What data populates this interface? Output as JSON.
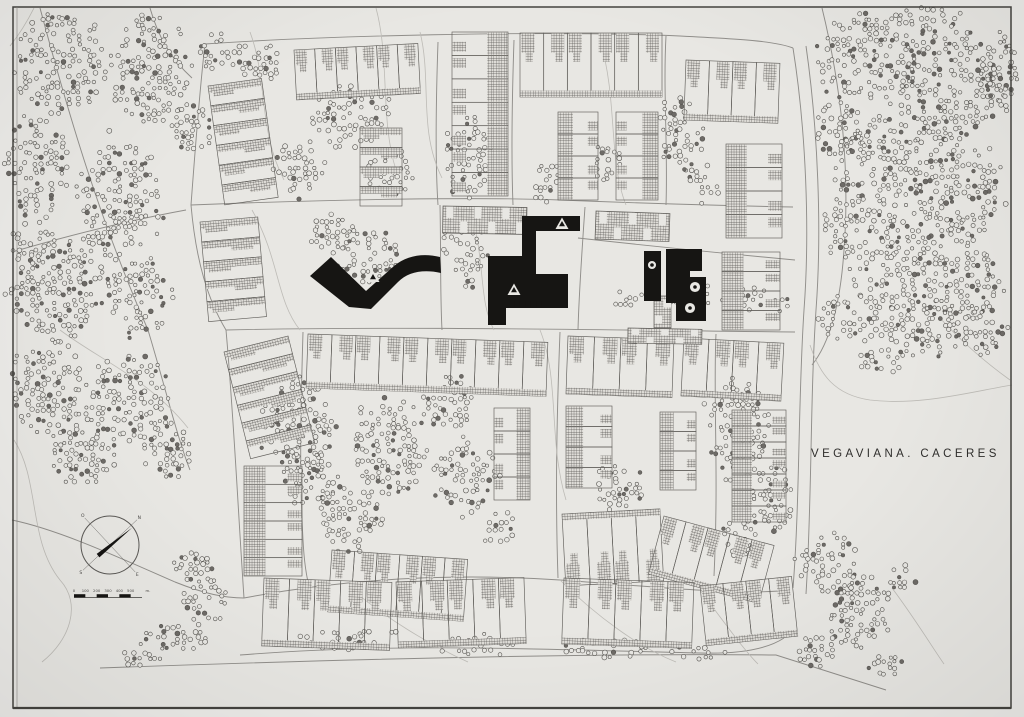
{
  "title": {
    "text": "VEGAVIANA. CACERES"
  },
  "palette": {
    "paper": "#e8e7e3",
    "margin": "#edece9",
    "frame": "#44433f",
    "road": "#908e8a",
    "faint": "#bdbbb6",
    "outline": "#605e5a",
    "tree_stroke": "#55534f",
    "tree_fill": "#6e6b67",
    "ink": "#161513",
    "hatch_bg": "#dedcd7",
    "hatch_line": "#4a4846"
  },
  "compass": {
    "cx": 110,
    "cy": 545,
    "r": 29,
    "needle_deg": -38,
    "cross_degs": [
      -43,
      47
    ],
    "labels": [
      {
        "t": "N",
        "deg": -43
      },
      {
        "t": "E",
        "deg": 47
      },
      {
        "t": "S",
        "deg": 137
      },
      {
        "t": "O",
        "deg": 227
      }
    ]
  },
  "scale_bar": {
    "x": 74,
    "y": 593,
    "w": 68,
    "segments": 6,
    "tick_labels": [
      "0",
      "100",
      "200",
      "300",
      "400",
      "500"
    ],
    "unit_label": "m."
  },
  "map": {
    "frame": {
      "x": 13,
      "y": 7,
      "w": 998,
      "h": 701
    },
    "roads": [
      {
        "d": "M205,44 C320,36 540,30 680,36 C740,39 775,41 793,48"
      },
      {
        "d": "M793,48 C806,130 810,230 804,310 C798,400 800,500 793,588"
      },
      {
        "d": "M806,46 C818,130 822,230 816,310 C810,400 812,500 806,594"
      },
      {
        "d": "M205,44 C199,96 195,152 191,205 C196,262 208,300 226,330 C234,420 238,510 244,598"
      },
      {
        "d": "M191,205 C340,199 480,197 560,200 C660,204 740,206 793,207"
      },
      {
        "d": "M226,330 C400,326 600,330 795,332"
      },
      {
        "d": "M244,598 C360,576 470,574 560,580 C660,587 740,596 790,590"
      },
      {
        "d": "M240,655 C400,642 560,650 700,653 C736,654 766,650 784,638"
      },
      {
        "d": "M100,668 C350,659 600,653 776,655 L886,690"
      },
      {
        "d": "M438,42 C436,100 435,160 438,205"
      },
      {
        "d": "M440,205 C441,250 440,292 442,330"
      },
      {
        "d": "M514,40 C512,100 511,155 513,205"
      },
      {
        "d": "M666,36 C663,90 668,150 666,205"
      },
      {
        "d": "M585,207 C582,250 579,292 578,330"
      },
      {
        "d": "M578,238 C650,246 720,253 795,260"
      },
      {
        "d": "M303,332 C301,400 299,470 303,540 C304,560 306,576 310,590"
      },
      {
        "d": "M560,332 C557,410 555,490 558,578"
      },
      {
        "d": "M716,334 C713,400 719,470 714,576"
      },
      {
        "d": "M40,8 C70,120 100,220 148,330 C166,390 178,440 190,470"
      },
      {
        "d": "M12,252 C60,238 120,222 186,210"
      },
      {
        "d": "M12,520 C60,530 120,558 175,582 C205,594 225,598 244,598"
      },
      {
        "d": "M150,8 C158,36 170,58 192,78"
      },
      {
        "d": "M822,8 C842,90 850,170 844,250 C840,310 828,345 812,365"
      },
      {
        "d": "M376,8 C390,60 380,120 396,170",
        "f": 1
      },
      {
        "d": "M600,40 C618,100 608,160 626,205",
        "f": 1
      },
      {
        "d": "M470,210 C486,260 478,300 494,330",
        "f": 1
      },
      {
        "d": "M252,210 C280,260 276,300 300,330",
        "f": 1
      },
      {
        "d": "M540,330 C560,380 548,440 566,500",
        "f": 1
      },
      {
        "d": "M350,588 C386,618 428,644 468,662",
        "f": 1
      },
      {
        "d": "M560,580 C596,616 640,648 676,662",
        "f": 1
      },
      {
        "d": "M700,590 C724,622 744,650 758,664",
        "f": 1
      },
      {
        "d": "M892,588 C916,620 934,650 944,664",
        "f": 1
      },
      {
        "d": "M60,330 C100,360 150,380 188,428",
        "f": 1
      },
      {
        "d": "M810,345 C820,375 835,395 870,400 C920,406 970,392 1012,385",
        "f": 1
      },
      {
        "d": "M940,318 C960,340 985,362 1010,380",
        "f": 1
      },
      {
        "d": "M14,440 C40,480 28,540 60,580 C82,604 70,640 42,662",
        "f": 1
      },
      {
        "d": "M250,32 C268,80 258,130 284,180",
        "f": 1
      },
      {
        "d": "M420,32 C432,80 418,130 442,178",
        "f": 1
      },
      {
        "d": "M34,8 C26,24 18,36 10,46",
        "f": 1
      }
    ],
    "tree_blobs": [
      [
        62,
        62,
        52,
        54
      ],
      [
        150,
        72,
        44,
        58
      ],
      [
        215,
        52,
        20,
        22
      ],
      [
        38,
        168,
        34,
        58
      ],
      [
        118,
        198,
        46,
        66
      ],
      [
        28,
        240,
        20,
        28
      ],
      [
        58,
        288,
        52,
        58
      ],
      [
        142,
        298,
        38,
        44
      ],
      [
        48,
        388,
        42,
        52
      ],
      [
        128,
        398,
        46,
        48
      ],
      [
        82,
        458,
        38,
        30
      ],
      [
        168,
        448,
        28,
        36
      ],
      [
        190,
        128,
        24,
        28
      ],
      [
        196,
        568,
        26,
        20
      ],
      [
        204,
        602,
        26,
        26
      ],
      [
        176,
        638,
        40,
        16
      ],
      [
        140,
        658,
        22,
        10
      ],
      [
        930,
        18,
        40,
        14
      ],
      [
        868,
        58,
        56,
        50
      ],
      [
        950,
        88,
        58,
        66
      ],
      [
        1002,
        70,
        18,
        44
      ],
      [
        840,
        132,
        26,
        36
      ],
      [
        878,
        168,
        52,
        58
      ],
      [
        958,
        192,
        48,
        58
      ],
      [
        842,
        228,
        22,
        34
      ],
      [
        898,
        268,
        48,
        52
      ],
      [
        968,
        282,
        38,
        44
      ],
      [
        850,
        318,
        38,
        26
      ],
      [
        922,
        330,
        52,
        32
      ],
      [
        988,
        332,
        28,
        26
      ],
      [
        884,
        360,
        28,
        14
      ],
      [
        828,
        562,
        32,
        34
      ],
      [
        858,
        612,
        38,
        40
      ],
      [
        820,
        652,
        26,
        18
      ],
      [
        884,
        664,
        26,
        12
      ],
      [
        902,
        582,
        18,
        16,
        0.38
      ],
      [
        256,
        62,
        28,
        20
      ],
      [
        352,
        118,
        44,
        36
      ],
      [
        300,
        168,
        32,
        32
      ],
      [
        392,
        172,
        28,
        26
      ],
      [
        368,
        258,
        36,
        30
      ],
      [
        332,
        232,
        26,
        22
      ],
      [
        468,
        158,
        26,
        46
      ],
      [
        464,
        252,
        24,
        40
      ],
      [
        546,
        182,
        16,
        22
      ],
      [
        606,
        160,
        14,
        28
      ],
      [
        680,
        132,
        26,
        40
      ],
      [
        700,
        182,
        20,
        22
      ],
      [
        752,
        300,
        40,
        16
      ],
      [
        692,
        298,
        26,
        16
      ],
      [
        628,
        300,
        18,
        12
      ],
      [
        298,
        428,
        42,
        50
      ],
      [
        388,
        448,
        42,
        56
      ],
      [
        466,
        478,
        36,
        40
      ],
      [
        348,
        518,
        36,
        36
      ],
      [
        448,
        402,
        30,
        30
      ],
      [
        310,
        480,
        30,
        30
      ],
      [
        736,
        428,
        36,
        55
      ],
      [
        768,
        498,
        30,
        40
      ],
      [
        740,
        540,
        22,
        22
      ],
      [
        618,
        488,
        30,
        26
      ],
      [
        500,
        528,
        20,
        20
      ],
      [
        352,
        640,
        56,
        13,
        0.45
      ],
      [
        478,
        646,
        46,
        12,
        0.45
      ],
      [
        608,
        648,
        46,
        12,
        0.45
      ],
      [
        698,
        652,
        36,
        10,
        0.45
      ]
    ],
    "strips": [
      {
        "x": 208,
        "y": 86,
        "w": 54,
        "h": 120,
        "vert": 1,
        "n": 6,
        "hatch": "rung",
        "rot": -8
      },
      {
        "x": 200,
        "y": 222,
        "w": 58,
        "h": 100,
        "vert": 1,
        "n": 5,
        "hatch": "rung",
        "rot": -5
      },
      {
        "x": 294,
        "y": 50,
        "w": 124,
        "h": 50,
        "n": 6,
        "hatch": "top",
        "spine": "bottom",
        "rot": -3
      },
      {
        "x": 360,
        "y": 128,
        "w": 42,
        "h": 78,
        "vert": 1,
        "n": 4,
        "hatch": "rung"
      },
      {
        "x": 452,
        "y": 32,
        "w": 56,
        "h": 164,
        "vert": 1,
        "n": 7,
        "hatch": "right",
        "caps": "left"
      },
      {
        "x": 520,
        "y": 33,
        "w": 142,
        "h": 64,
        "n": 6,
        "hatch": "top",
        "spine": "bottom"
      },
      {
        "x": 686,
        "y": 60,
        "w": 94,
        "h": 60,
        "n": 4,
        "hatch": "top",
        "spine": "bottom",
        "rot": 2
      },
      {
        "x": 558,
        "y": 112,
        "w": 40,
        "h": 88,
        "vert": 1,
        "n": 4,
        "hatch": "left",
        "caps": "right"
      },
      {
        "x": 616,
        "y": 112,
        "w": 42,
        "h": 88,
        "vert": 1,
        "n": 4,
        "hatch": "right",
        "caps": "left"
      },
      {
        "x": 726,
        "y": 144,
        "w": 56,
        "h": 94,
        "vert": 1,
        "n": 4,
        "hatch": "left",
        "caps": "right"
      },
      {
        "x": 722,
        "y": 252,
        "w": 58,
        "h": 78,
        "vert": 1,
        "n": 4,
        "hatch": "left",
        "caps": "right"
      },
      {
        "x": 224,
        "y": 352,
        "w": 66,
        "h": 110,
        "vert": 1,
        "n": 6,
        "hatch": "rung",
        "rot": -14
      },
      {
        "x": 244,
        "y": 466,
        "w": 58,
        "h": 110,
        "vert": 1,
        "n": 6,
        "hatch": "left",
        "caps": "right"
      },
      {
        "x": 308,
        "y": 334,
        "w": 240,
        "h": 54,
        "n": 10,
        "hatch": "top",
        "spine": "bottom",
        "rot": 2
      },
      {
        "x": 332,
        "y": 550,
        "w": 136,
        "h": 62,
        "n": 6,
        "hatch": "top",
        "spine": "bottom",
        "rot": 4
      },
      {
        "x": 562,
        "y": 514,
        "w": 98,
        "h": 72,
        "n": 4,
        "hatch": "bottom",
        "spine": "top",
        "rot": -3
      },
      {
        "x": 566,
        "y": 406,
        "w": 46,
        "h": 82,
        "vert": 1,
        "n": 4,
        "hatch": "left",
        "caps": "right"
      },
      {
        "x": 494,
        "y": 408,
        "w": 36,
        "h": 92,
        "vert": 1,
        "n": 4,
        "hatch": "right",
        "caps": "left"
      },
      {
        "x": 568,
        "y": 336,
        "w": 106,
        "h": 58,
        "n": 4,
        "hatch": "top",
        "spine": "bottom",
        "rot": 2
      },
      {
        "x": 684,
        "y": 338,
        "w": 100,
        "h": 58,
        "n": 4,
        "hatch": "top",
        "spine": "bottom",
        "rot": 3
      },
      {
        "x": 660,
        "y": 412,
        "w": 36,
        "h": 78,
        "vert": 1,
        "n": 4,
        "hatch": "left",
        "caps": "right"
      },
      {
        "x": 732,
        "y": 410,
        "w": 54,
        "h": 112,
        "vert": 1,
        "n": 7,
        "hatch": "left",
        "caps": "right"
      },
      {
        "x": 664,
        "y": 516,
        "w": 114,
        "h": 60,
        "n": 5,
        "hatch": "top",
        "spine": "bottom",
        "rot": 15
      },
      {
        "x": 264,
        "y": 578,
        "w": 128,
        "h": 68,
        "n": 5,
        "hatch": "top",
        "spine": "bottom",
        "rot": 2
      },
      {
        "x": 396,
        "y": 582,
        "w": 128,
        "h": 66,
        "n": 5,
        "hatch": "top",
        "spine": "bottom",
        "rot": -2
      },
      {
        "x": 564,
        "y": 578,
        "w": 130,
        "h": 66,
        "n": 5,
        "hatch": "top",
        "spine": "bottom",
        "rot": 2
      },
      {
        "x": 700,
        "y": 586,
        "w": 92,
        "h": 60,
        "n": 4,
        "hatch": "top",
        "spine": "bottom",
        "rot": -6
      },
      {
        "x": 443,
        "y": 206,
        "w": 84,
        "h": 27,
        "n": 6,
        "style": "checker",
        "rot": 1
      },
      {
        "x": 596,
        "y": 211,
        "w": 74,
        "h": 28,
        "n": 5,
        "style": "checker",
        "rot": 2
      },
      {
        "x": 628,
        "y": 328,
        "w": 74,
        "h": 15,
        "n": 5,
        "style": "checker",
        "rot": 1
      },
      {
        "x": 654,
        "y": 296,
        "w": 17,
        "h": 32,
        "vert": 1,
        "n": 2,
        "style": "checker"
      }
    ],
    "civic": {
      "paths": [
        "M310,276 L331,257 L366,291 L394,266 C407,255 424,253 440,257 L441,273 C423,269 408,272 398,282 L371,309 L349,307 Z",
        "M522,216 L580,216 L580,231 L536,231 L536,276 L522,276 Z",
        "M488,256 L522,256 L522,274 L568,274 L568,308 L506,308 L506,325 L488,325 Z",
        "M644,251 L661,251 L661,301 L644,301 Z",
        "M666,249 L702,249 L702,271 L690,271 L690,277 L706,277 L706,321 L676,321 L676,303 L666,303 Z"
      ],
      "triangle_markers": [
        [
          373,
          277
        ],
        [
          562,
          224
        ],
        [
          514,
          290
        ]
      ],
      "circle_markers": [
        [
          652,
          265,
          4.5
        ],
        [
          695,
          287,
          5.5
        ],
        [
          690,
          308,
          5.5
        ]
      ],
      "tick_row": {
        "x": 512,
        "y": 301,
        "n": 6,
        "step": 5.5
      }
    }
  }
}
